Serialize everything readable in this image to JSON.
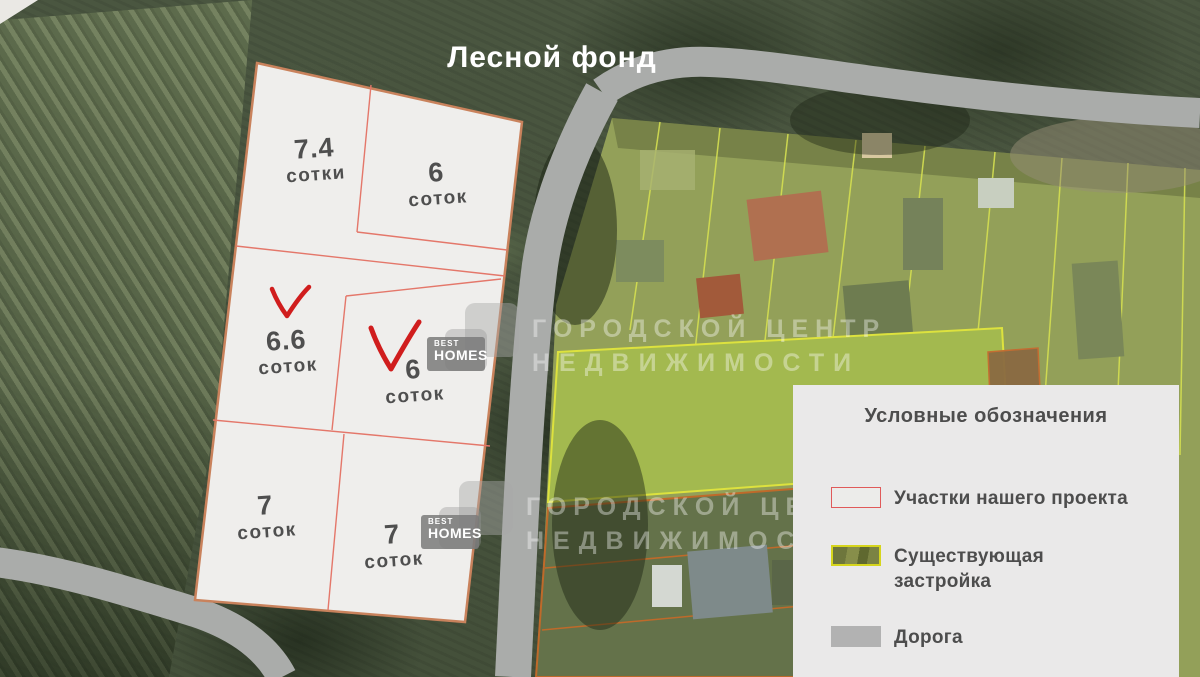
{
  "map": {
    "title": "Лесной фонд",
    "plots": [
      {
        "area": "7.4",
        "unit": "сотки",
        "checked": false
      },
      {
        "area": "6",
        "unit": "соток",
        "checked": false
      },
      {
        "area": "6.6",
        "unit": "соток",
        "checked": true
      },
      {
        "area": "6",
        "unit": "соток",
        "checked": true
      },
      {
        "area": "7",
        "unit": "соток",
        "checked": false
      },
      {
        "area": "7",
        "unit": "соток",
        "checked": false
      }
    ]
  },
  "legend": {
    "title": "Условные обозначения",
    "items": [
      {
        "label": "Участки нашего проекта",
        "swatch": "project-plot"
      },
      {
        "label": "Существующая застройка",
        "swatch": "existing-buildings"
      },
      {
        "label": "Дорога",
        "swatch": "road"
      }
    ]
  },
  "watermark": {
    "brand_top": "BEST",
    "brand_bottom": "HOMES",
    "line1": "ГОРОДСКОЙ ЦЕНТР",
    "line2": "НЕДВИЖИМОСТИ"
  },
  "colors": {
    "checkmark_red": "#d01d1d",
    "plot_fill": "#efeeec",
    "plot_border": "#c9825c",
    "plot_inner_line": "#e4776a",
    "road_gray": "#aaacaa",
    "existing_border_yellow": "#d6d51c",
    "legend_bg": "#eae9e9",
    "text_dark": "#4f4f4f"
  }
}
